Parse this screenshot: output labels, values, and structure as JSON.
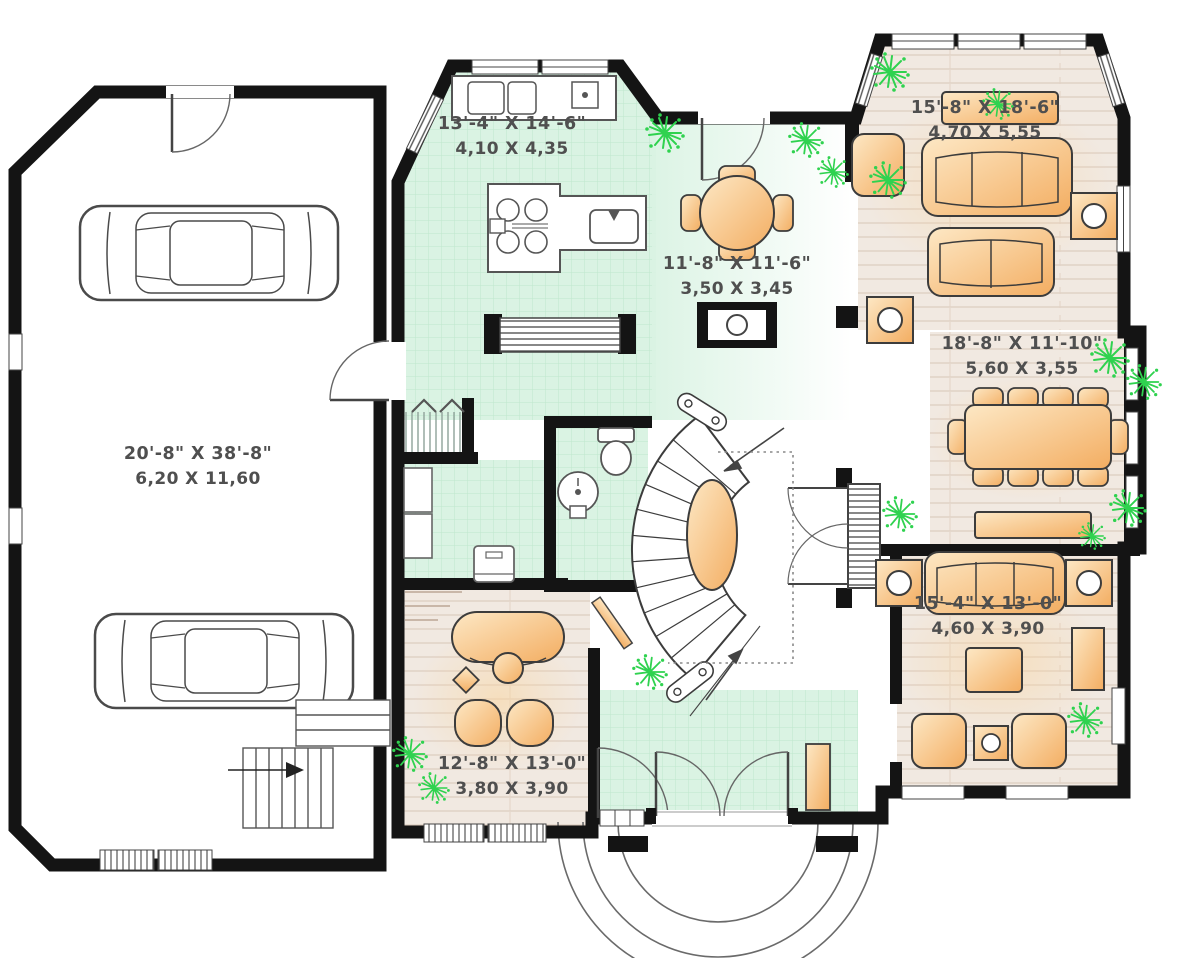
{
  "plan": {
    "type": "floor-plan",
    "rooms": [
      {
        "id": "kitchen",
        "imperial": "13'-4\" X 14'-6\"",
        "metric": "4,10 X 4,35"
      },
      {
        "id": "breakfast",
        "imperial": "11'-8\" X 11'-6\"",
        "metric": "3,50 X 3,45"
      },
      {
        "id": "living",
        "imperial": "15'-8\" X 18'-6\"",
        "metric": "4,70 X 5,55"
      },
      {
        "id": "dining",
        "imperial": "18'-8\" X 11'-10\"",
        "metric": "5,60 X 3,55"
      },
      {
        "id": "garage",
        "imperial": "20'-8\" X 38'-8\"",
        "metric": "6,20 X 11,60"
      },
      {
        "id": "family",
        "imperial": "15'-4\" X 13'-0\"",
        "metric": "4,60 X 3,90"
      },
      {
        "id": "office",
        "imperial": "12'-8\" X 13'-0\"",
        "metric": "3,80 X 3,90"
      }
    ],
    "palette": {
      "wall": "#141414",
      "tile_floor": "#daf3e3",
      "tile_grid": "#bfe7cd",
      "wood_floor": "#f1e9e1",
      "wood_line": "#d8c6b8",
      "furniture": "#f3ad61",
      "furniture_light": "#fde3b8",
      "plant": "#2fd24f",
      "label_text": "#4f4f4f"
    }
  }
}
